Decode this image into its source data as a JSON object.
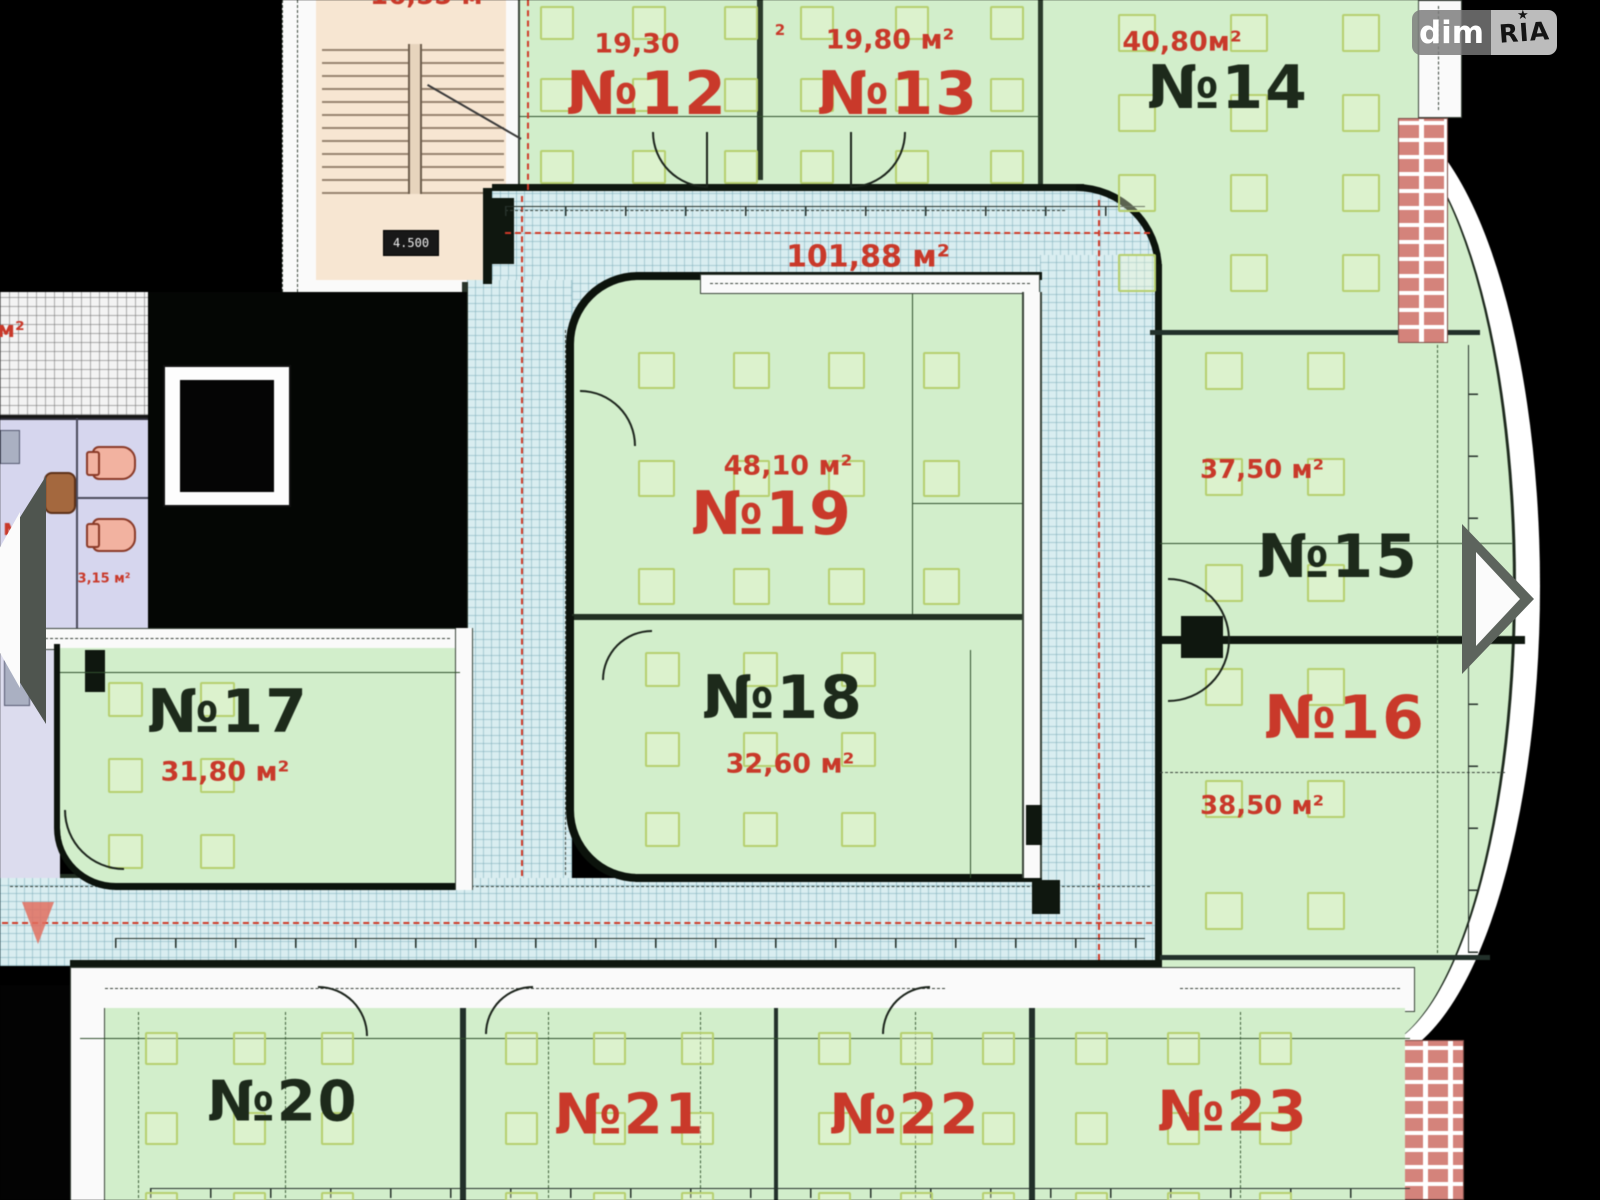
{
  "watermark": {
    "left": "dim",
    "right": "RIA",
    "star": "★"
  },
  "nav": {
    "prev": "previous image",
    "next": "next image"
  },
  "corridor": {
    "area_label": "101,88 м²"
  },
  "stairwell": {
    "area_label": "16,55 м²",
    "level_mark": "4.500"
  },
  "wc": {
    "cut_top_area": "0 м²",
    "cut_mid_area": "2 м²",
    "small_area": "3,15 м²"
  },
  "notes": {
    "tiny_digit": "2"
  },
  "rooms": {
    "r12": {
      "number": "№12",
      "area": "19,30"
    },
    "r13": {
      "number": "№13",
      "area": "19,80 м²"
    },
    "r14": {
      "number": "№14",
      "area": "40,80м²"
    },
    "r15": {
      "number": "№15",
      "area": "37,50 м²"
    },
    "r16": {
      "number": "№16",
      "area": "38,50 м²"
    },
    "r17": {
      "number": "№17",
      "area": "31,80 м²"
    },
    "r18": {
      "number": "№18",
      "area": "32,60 м²"
    },
    "r19": {
      "number": "№19",
      "area": "48,10 м²"
    },
    "r20": {
      "number": "№20"
    },
    "r21": {
      "number": "№21"
    },
    "r22": {
      "number": "№22"
    },
    "r23": {
      "number": "№23"
    }
  },
  "colors": {
    "room_green": "#d2eecb",
    "corridor_tile": "#d9edf0",
    "label_red": "#c9392a",
    "label_black": "#1d2a1b",
    "stair_beige": "#f7e6d2",
    "wc_lavender": "#d6d6ee",
    "brick": "#d4837b",
    "background": "#000000"
  }
}
